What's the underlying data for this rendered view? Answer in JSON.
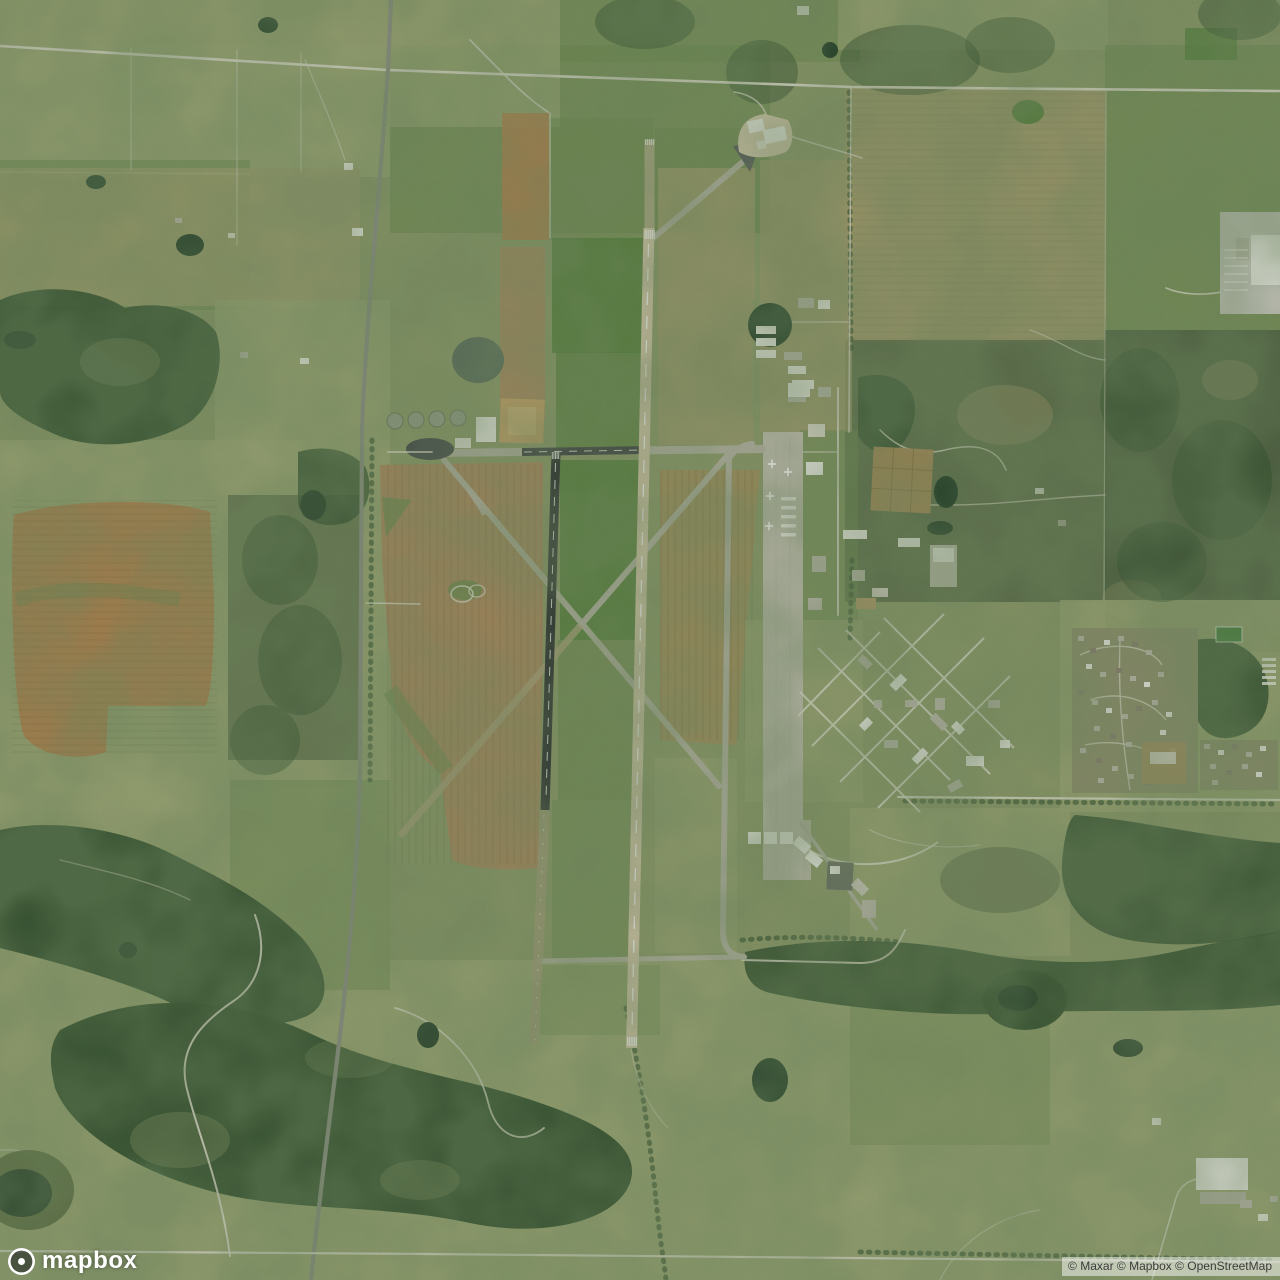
{
  "branding": {
    "logo_text": "mapbox"
  },
  "attribution": {
    "text": "© Maxar © Mapbox © OpenStreetMap"
  },
  "map": {
    "style": "satellite",
    "features": {
      "airfield": "airfield with two parallel runways, crossing diagonal taxiways, apron and hangar rows",
      "base_area": "building complex with diamond street grid and housing subdivision on east side",
      "terrain": "farm fields, plowed brown parcels, dark woodland, ponds, winding dirt trails"
    }
  },
  "palette": {
    "base": "#8f9c6b",
    "field_pale": "#9ea977",
    "field_green": "#6d8a4f",
    "field_bright": "#4e7d36",
    "field_olive": "#a39c6e",
    "field_tan": "#a8905e",
    "plowed_brown": "#b5824e",
    "plowed_light": "#ad8a60",
    "forest_dark": "#33502f",
    "scrub_dark": "#485c3e",
    "pond_dark": "#1e3a26",
    "pond_gray": "#70806f",
    "road_dirt": "#e2dfd1",
    "road_highway": "#8e9087",
    "runway_main": "#d6c9ac",
    "runway_black": "#26282d",
    "taxiway": "#b8b5a7",
    "apron": "#c3c0b2",
    "building_white": "#f5f4ef",
    "building_gray": "#bfbcb0",
    "marking_white": "#ffffff"
  }
}
